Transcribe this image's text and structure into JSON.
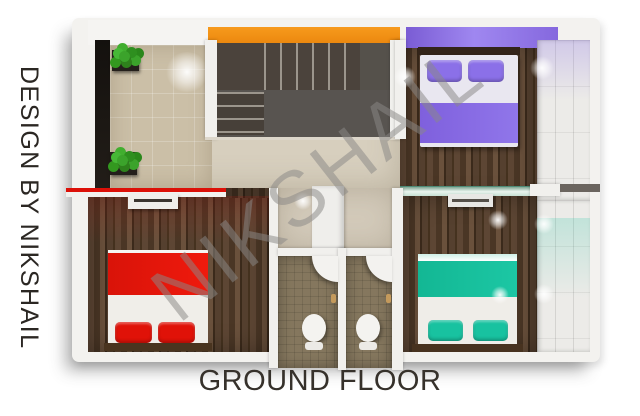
{
  "branding": {
    "side_caption": "DESIGN BY NIKSHAIL",
    "watermark": "NIKSHAIL"
  },
  "plan": {
    "floor_label": "GROUND FLOOR",
    "view": "top-down-3d-render",
    "rooms": [
      {
        "name": "foyer",
        "floor": "beige-tile",
        "features": [
          "potted-plant",
          "potted-plant",
          "dark-accent-wall",
          "ceiling-light"
        ]
      },
      {
        "name": "staircase",
        "features": [
          "orange-accent-wall",
          "upper-treads",
          "landing",
          "lower-treads"
        ]
      },
      {
        "name": "bedroom-purple",
        "accent_color": "#8b70e8",
        "features": [
          "double-bed",
          "purple-pillows",
          "purple-blanket",
          "purple-ceiling-band",
          "wardrobe",
          "glass-partition"
        ]
      },
      {
        "name": "hallway-passage",
        "floor": "cream",
        "features": [
          "wall-block"
        ]
      },
      {
        "name": "bedroom-red",
        "accent_color": "#e5130a",
        "features": [
          "double-bed",
          "red-pillows",
          "red-blanket",
          "red-wall-strip",
          "dresser"
        ]
      },
      {
        "name": "bathroom-1",
        "features": [
          "corner-sink",
          "toilet",
          "door-handle"
        ]
      },
      {
        "name": "bathroom-2",
        "features": [
          "corner-sink",
          "toilet",
          "door-handle"
        ]
      },
      {
        "name": "bedroom-teal",
        "accent_color": "#16bd9b",
        "features": [
          "double-bed",
          "teal-pillows",
          "teal-blanket",
          "wardrobe",
          "media-unit",
          "glass-partition"
        ]
      }
    ],
    "palette": {
      "orange_wall": "#f4920f",
      "purple": "#8b70e8",
      "red": "#e5130a",
      "teal": "#16bd9b",
      "wood_floor": "#54402f",
      "beige_tile": "#cbbfa7",
      "hall_cream": "#d7cfbe",
      "bathroom_tile": "#85775e",
      "wall_white": "#f1f0ed",
      "stair_dark": "#4b433c",
      "text": "#36312b"
    }
  }
}
